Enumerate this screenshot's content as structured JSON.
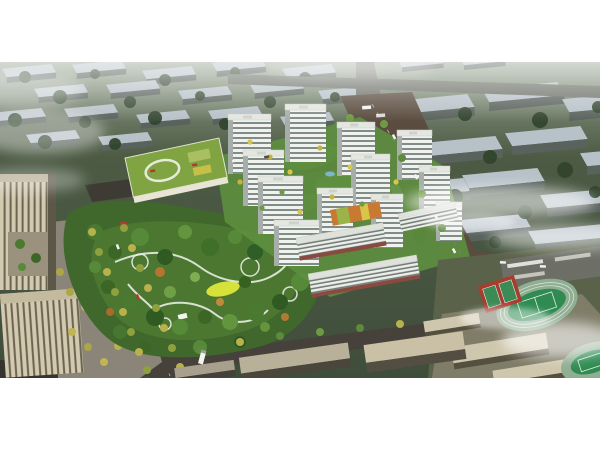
{
  "image": {
    "kind": "aerial architectural rendering",
    "description": "Bird's-eye rendering of a residential development: a cluster of white high-rise towers around green courtyards, a green-roof kindergarten, a large landscaped park with winding white paths and a yellow lawn, tree-lined avenues, beige office towers at the lower left, a school campus with a running track and red sports courts at the lower right, ranks of existing slab apartment blocks receding into a hazy green field, and soft white clouds drifting over the scene. White margins frame the image top and bottom.",
    "frame": {
      "top_margin_color": "#ffffff",
      "bottom_margin_color": "#ffffff"
    }
  },
  "scene": {
    "elements": [
      {
        "name": "background-apartment-rows",
        "roof_color": "#b7c1c8",
        "facade_color": "#59625c"
      },
      {
        "name": "background-field",
        "color": "#47553f"
      },
      {
        "name": "residential-towers",
        "facade_color": "#f0f2ee",
        "window_band_color": "#818b88",
        "roof_color": "#e4e6e1",
        "count_visible": 12
      },
      {
        "name": "mid-rise-slabs-with-shops",
        "awning_color": "#8a4a3f"
      },
      {
        "name": "kindergarten-green-roof",
        "roof_color": "#7fa441",
        "roof_ring_color": "#e8eade"
      },
      {
        "name": "central-park",
        "greens": [
          "#4f7a33",
          "#3c6128"
        ],
        "path_color": "#e9ece4",
        "meadow_color": "#d6e23a"
      },
      {
        "name": "office-towers",
        "color": "#cfc6ac"
      },
      {
        "name": "tree-lined-avenue",
        "street_tree_colors": [
          "#b8b14c",
          "#8fa03e"
        ]
      },
      {
        "name": "school-running-track",
        "track_color": "#8fae92",
        "infield_color": "#2f8b52"
      },
      {
        "name": "basketball-courts",
        "surface_color": "#a63d2e",
        "court_color": "#3c8a55"
      },
      {
        "name": "school-buildings",
        "color": "#cfc7ad"
      },
      {
        "name": "main-road",
        "color": "#5a4c3f"
      },
      {
        "name": "city-road",
        "color": "#46423b"
      },
      {
        "name": "clouds",
        "color": "#ffffff"
      }
    ]
  },
  "palette": {
    "margin_white": "#ffffff",
    "field_green": "#47553f",
    "haze": "#ffffff",
    "bg_roof": "#b7c1c8",
    "bg_facade": "#59625c",
    "tower_white": "#f0f2ee",
    "window_gray": "#818b88",
    "road_brown": "#5a4c3f",
    "road_asphalt": "#46423b",
    "park_green_light": "#4f7a33",
    "park_green_dark": "#3c6128",
    "meadow_yellow": "#d6e23a",
    "kindergarten_roof": "#7fa441",
    "office_beige": "#cfc6ac",
    "school_beige": "#cfc7ad",
    "track_green": "#2f8b52",
    "court_red": "#a63d2e",
    "street_tree_yellow": "#b8b14c"
  }
}
